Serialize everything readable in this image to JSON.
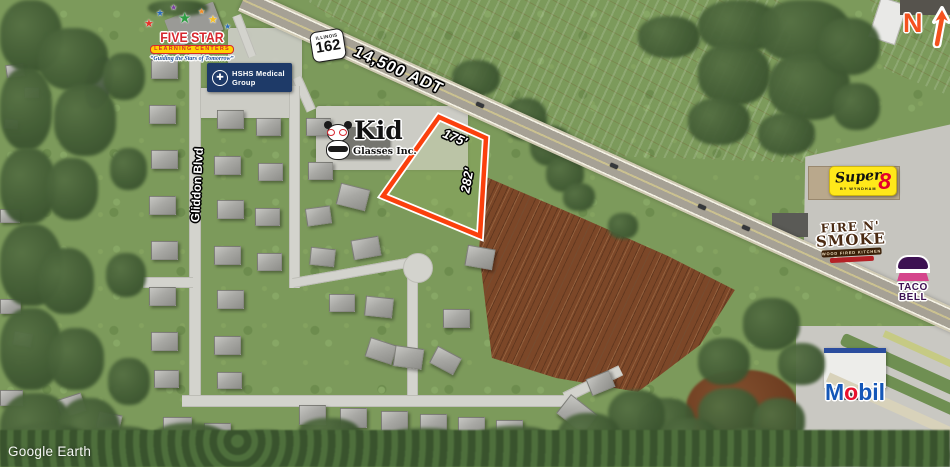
{
  "map": {
    "attribution": "Google Earth",
    "north_indicator": "N"
  },
  "highway": {
    "shield_state": "ILLINOIS",
    "shield_route": "162",
    "traffic_count": "14,500 ADT"
  },
  "parcel": {
    "frontage": "175'",
    "depth": "282'",
    "outline_color": "#FB400D"
  },
  "streets": {
    "gliddon": "Gliddon Blvd"
  },
  "businesses": {
    "five_star": {
      "name": "FIVE STAR",
      "banner": "LEARNING CENTERS",
      "tagline": "“Guiding the Stars of Tomorrow”"
    },
    "hshs": {
      "name": "HSHS Medical Group"
    },
    "kid_glasses": {
      "name": "Kid",
      "subtitle": "Glasses Inc."
    },
    "super_8": {
      "name": "Super",
      "numeral": "8",
      "byline": "BY WYNDHAM"
    },
    "fire_n_smoke": {
      "line1": "FIRE N'",
      "line2": "SMOKE",
      "sub": "WOOD FIRED KITCHEN"
    },
    "taco_bell": {
      "line1": "TACO",
      "line2": "BELL"
    },
    "mobil": {
      "part1": "M",
      "accent": "o",
      "part2": "bil"
    }
  },
  "colors": {
    "parcel_outline": "#FB400D",
    "north_arrow": "#F4511E",
    "super8_yellow": "#FFE81A",
    "super8_red": "#E4002B",
    "taco_bell_purple": "#3D1152",
    "mobil_blue": "#1557B8",
    "mobil_red": "#E8112D",
    "hshs_navy": "#1E3A68",
    "five_star_red": "#D7282F"
  }
}
